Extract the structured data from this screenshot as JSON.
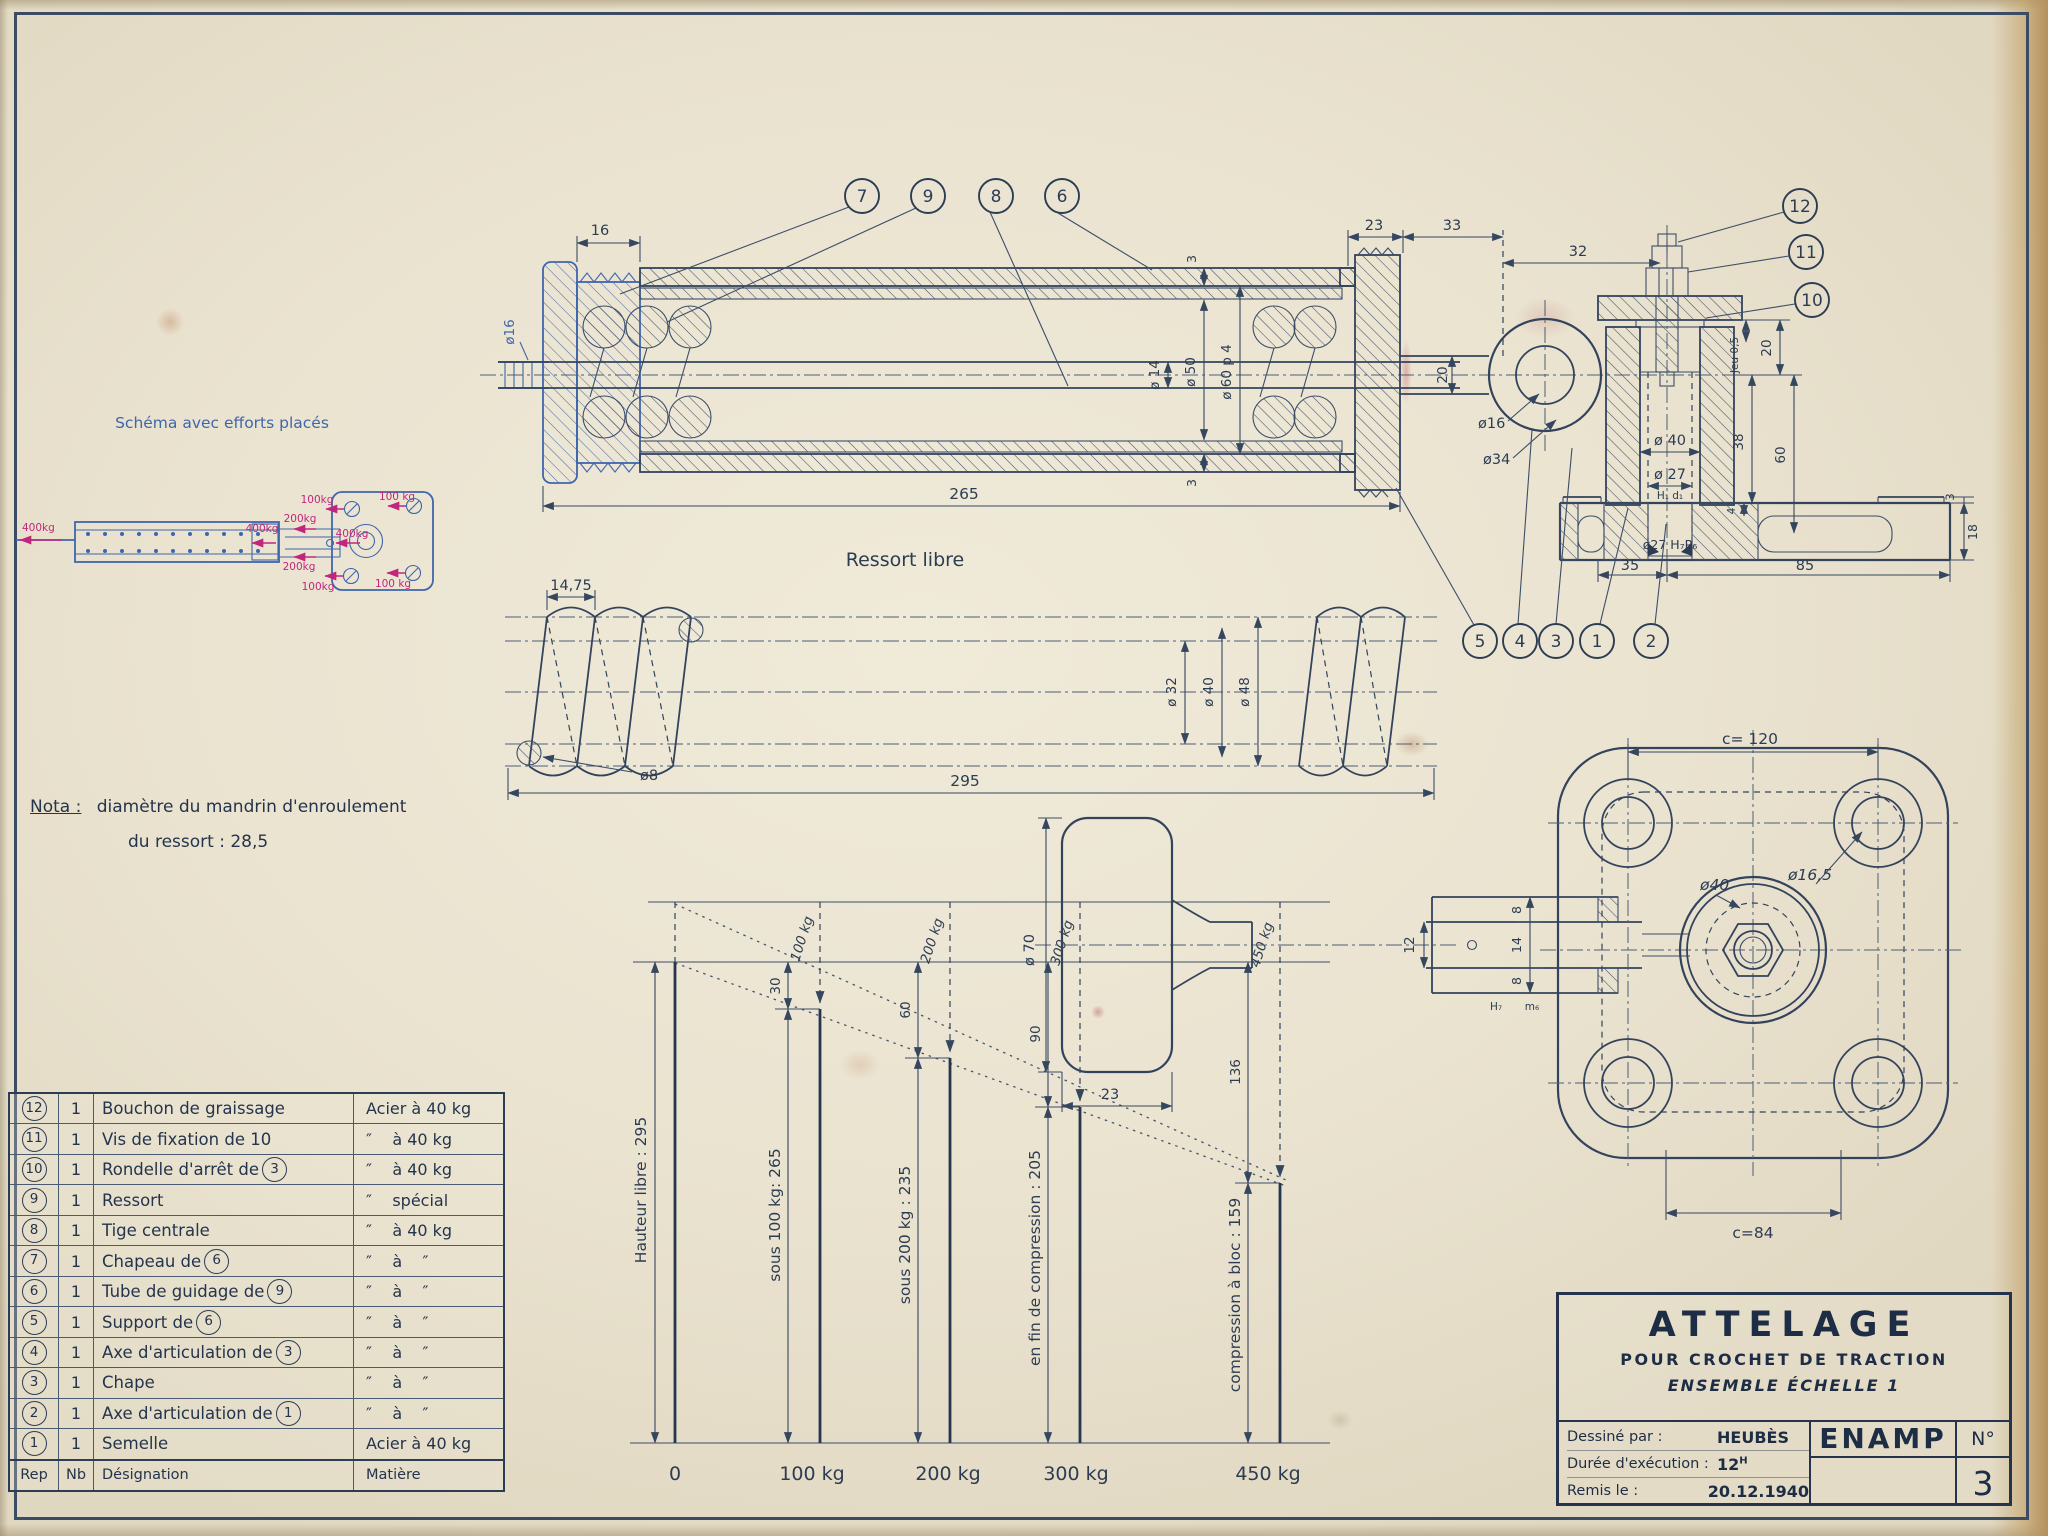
{
  "colors": {
    "ink": "#2e3e56",
    "blue": "#3f66ac",
    "red": "#c2267c",
    "paper": "#e9e2d0"
  },
  "schema": {
    "title": "Schéma avec efforts placés",
    "force_left": "400kg",
    "force_rod": "400kg",
    "force_top": "200kg",
    "force_bottom": "200kg",
    "force_corner_tl": "100kg",
    "force_corner_tr": "100 kg",
    "force_corner_bl": "100kg",
    "force_corner_br": "100 kg",
    "force_center": "400kg"
  },
  "nota": {
    "label": "Nota :",
    "line1": "diamètre du mandrin d'enroulement",
    "line2": "du ressort :  28,5"
  },
  "assembly": {
    "callouts_top": [
      "7",
      "9",
      "8",
      "6"
    ],
    "callouts_right": [
      "12",
      "11",
      "10"
    ],
    "callouts_bottom": [
      "5",
      "4",
      "3",
      "1",
      "2"
    ],
    "dims": {
      "d16": "16",
      "dia16_rod": "ø16",
      "wall3_top": "3",
      "wall3_bot": "3",
      "dia14": "ø 14",
      "dia50": "ø 50",
      "dia60": "ø 60 p 4",
      "len265": "265",
      "c23": "23",
      "c33": "33",
      "c32": "32",
      "neck20": "20",
      "dia16_pin": "ø16",
      "dia34": "ø34",
      "dia40": "ø 40",
      "dia27": "ø 27",
      "fit27": "H₁ d₁",
      "jeu": "Jeu 0,5",
      "h20": "20",
      "h38": "38",
      "h60": "60",
      "h4": "4",
      "pad3": "3",
      "base18": "18",
      "b35": "35",
      "b85": "85",
      "bore": "ø27 H₇P₆"
    }
  },
  "spring": {
    "title": "Ressort libre",
    "pitch": "14,75",
    "wire": "ø8",
    "length": "295",
    "dia_in": "ø 32",
    "dia_mid": "ø 40",
    "dia_out": "ø 48"
  },
  "chart_data": {
    "type": "bar",
    "x_unit": "kg",
    "y_unit": "mm",
    "loads_kg": [
      0,
      100,
      200,
      300,
      450
    ],
    "spring_heights_mm": [
      295,
      265,
      235,
      205,
      159
    ],
    "deflections_mm": [
      0,
      30,
      60,
      90,
      136
    ],
    "ylim": [
      0,
      295
    ],
    "grid": false,
    "x_tick_labels": [
      "0",
      "100 kg",
      "200 kg",
      "300 kg",
      "450 kg"
    ],
    "bar_dim_labels": [
      "Hauteur libre : 295",
      "sous 100 kg: 265",
      "sous 200 kg : 235",
      "en fin de compression : 205",
      "compression à bloc : 159"
    ],
    "deflection_labels": [
      "30",
      "60",
      "90",
      "136"
    ],
    "load_arrow_labels": [
      "100 kg",
      "200 kg",
      "300 kg",
      "450 kg"
    ]
  },
  "plate": {
    "c120": "c= 120",
    "c84": "c=84",
    "dia40": "ø40",
    "dia165": "ø16,5",
    "dia70": "ø 70",
    "w23": "23",
    "h12": "12",
    "t8a": "8",
    "t14": "14",
    "t8b": "8",
    "fit_h7": "H₇",
    "fit_m6": "m₆"
  },
  "parts_table": {
    "header": {
      "rep": "Rep",
      "nb": "Nb",
      "designation": "Désignation",
      "matiere": "Matière"
    },
    "rows": [
      {
        "rep": "12",
        "nb": "1",
        "designation": [
          {
            "t": "Bouchon de graissage"
          }
        ],
        "matiere": "Acier à 40 kg"
      },
      {
        "rep": "11",
        "nb": "1",
        "designation": [
          {
            "t": "Vis de fixation de 10"
          }
        ],
        "matiere": "″    à 40 kg"
      },
      {
        "rep": "10",
        "nb": "1",
        "designation": [
          {
            "t": "Rondelle d'arrêt de "
          },
          {
            "c": "3"
          }
        ],
        "matiere": "″    à 40 kg"
      },
      {
        "rep": "9",
        "nb": "1",
        "designation": [
          {
            "t": "Ressort"
          }
        ],
        "matiere": "″    spécial"
      },
      {
        "rep": "8",
        "nb": "1",
        "designation": [
          {
            "t": "Tige centrale"
          }
        ],
        "matiere": "″    à 40 kg"
      },
      {
        "rep": "7",
        "nb": "1",
        "designation": [
          {
            "t": "Chapeau de "
          },
          {
            "c": "6"
          }
        ],
        "matiere": "″    à    ″"
      },
      {
        "rep": "6",
        "nb": "1",
        "designation": [
          {
            "t": "Tube de guidage de "
          },
          {
            "c": "9"
          }
        ],
        "matiere": "″    à    ″"
      },
      {
        "rep": "5",
        "nb": "1",
        "designation": [
          {
            "t": "Support de "
          },
          {
            "c": "6"
          }
        ],
        "matiere": "″    à    ″"
      },
      {
        "rep": "4",
        "nb": "1",
        "designation": [
          {
            "t": "Axe d'articulation de "
          },
          {
            "c": "3"
          }
        ],
        "matiere": "″    à    ″"
      },
      {
        "rep": "3",
        "nb": "1",
        "designation": [
          {
            "t": "Chape"
          }
        ],
        "matiere": "″    à    ″"
      },
      {
        "rep": "2",
        "nb": "1",
        "designation": [
          {
            "t": "Axe d'articulation de "
          },
          {
            "c": "1"
          }
        ],
        "matiere": "″    à    ″"
      },
      {
        "rep": "1",
        "nb": "1",
        "designation": [
          {
            "t": "Semelle"
          }
        ],
        "matiere": "Acier à 40 kg"
      }
    ]
  },
  "titleblock": {
    "title": "ATTELAGE",
    "subtitle": "POUR CROCHET DE TRACTION",
    "scale_line": "ENSEMBLE ÉCHELLE 1",
    "drawn_label": "Dessiné par :",
    "drawn_value": "HEUBÈS",
    "duration_label": "Durée d'exécution :",
    "duration_value": "12",
    "duration_unit": "H",
    "date_label": "Remis le :",
    "date_value": "20.12.1940",
    "org": "ENAMP",
    "num_label": "N°",
    "num_value": "3"
  }
}
